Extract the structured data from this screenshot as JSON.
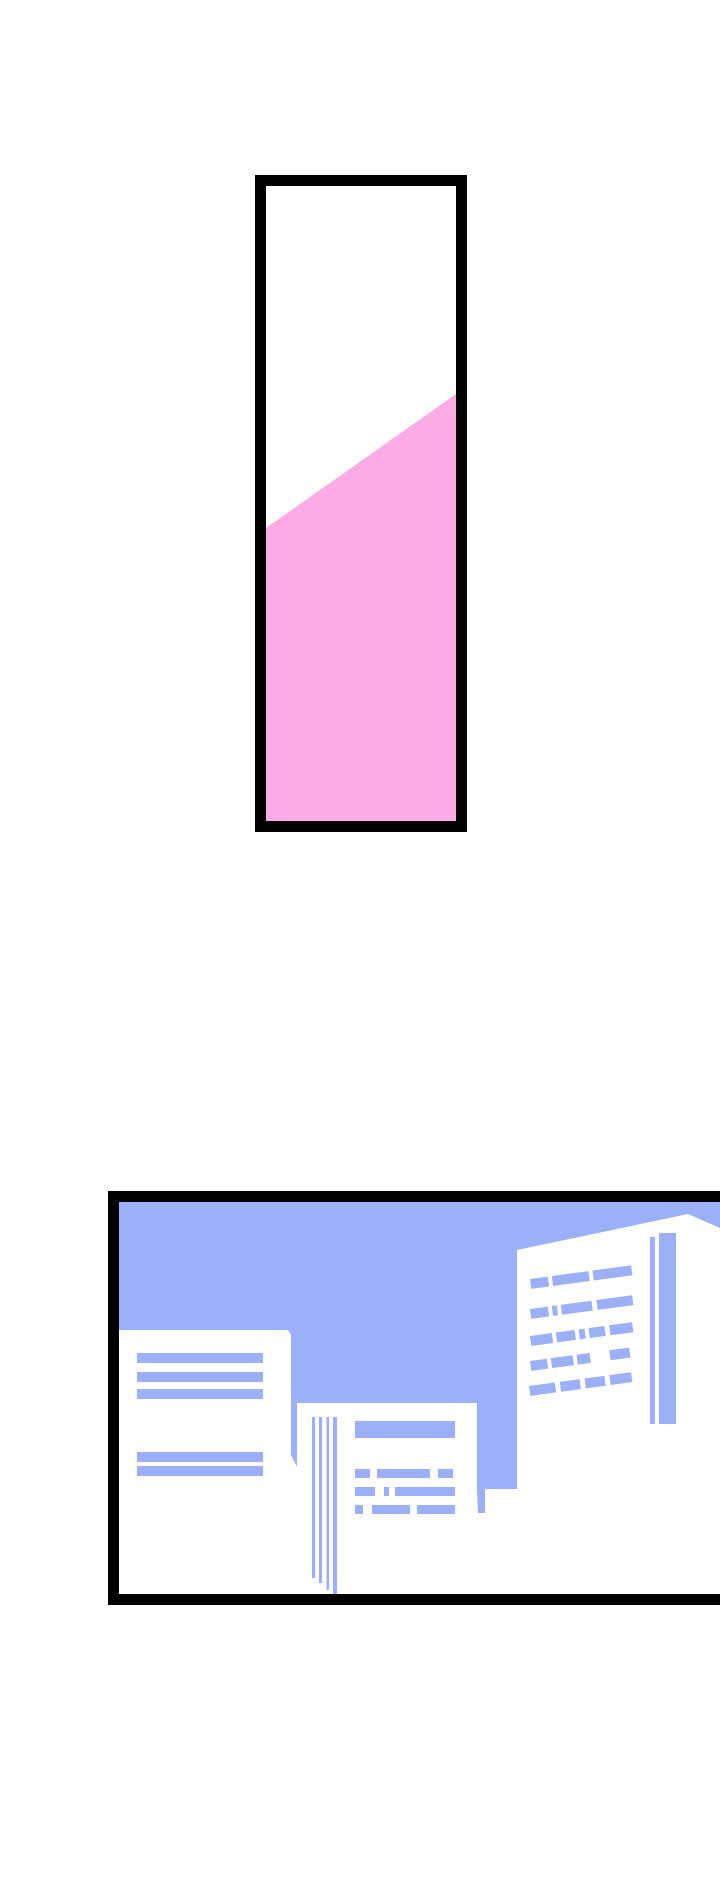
{
  "page": {
    "kind": "comic-strip-page",
    "panel_count": 2
  },
  "colors": {
    "page-bg": "#ffffff",
    "panel-bg": "#ffffff",
    "border": "#000000",
    "pink": "#fcabe5",
    "sky": "#9bb0f8"
  },
  "panels": [
    {
      "id": "panel-1",
      "shapes": [
        "pink-diagonal-fill"
      ]
    },
    {
      "id": "panel-2",
      "shapes": [
        "blue-sky",
        "paper-document-left",
        "paper-document-middle",
        "office-building-right"
      ]
    }
  ]
}
